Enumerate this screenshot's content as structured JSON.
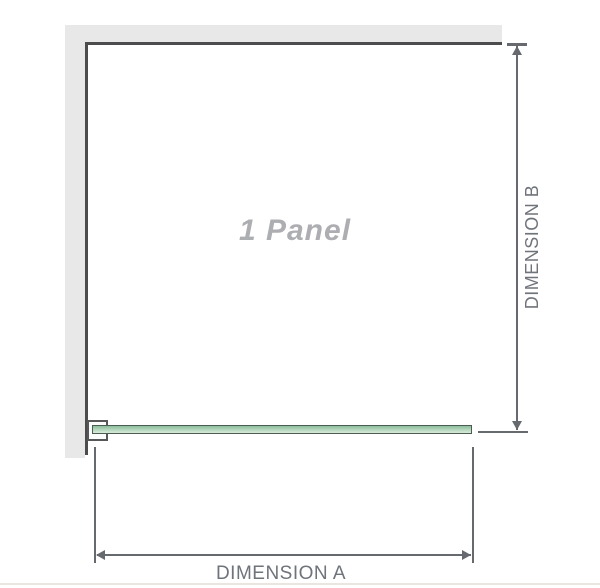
{
  "diagram": {
    "panel_label": "1 Panel",
    "dimension_a": {
      "label": "DIMENSION A"
    },
    "dimension_b": {
      "label": "DIMENSION B"
    }
  },
  "colors": {
    "wall": "#e8e8e9",
    "panel_edge": "#4c4c4e",
    "dimension_line": "#66696d",
    "label_text": "#6f747a",
    "panel_label_text": "#adaeb2",
    "glass_border": "#4e5b51",
    "glass_top": "#8cbe9c",
    "glass_bottom": "#d8ecda",
    "bracket_border": "#565759",
    "bracket_fill": "#fcfcfc",
    "footer_line": "#eae6df"
  }
}
